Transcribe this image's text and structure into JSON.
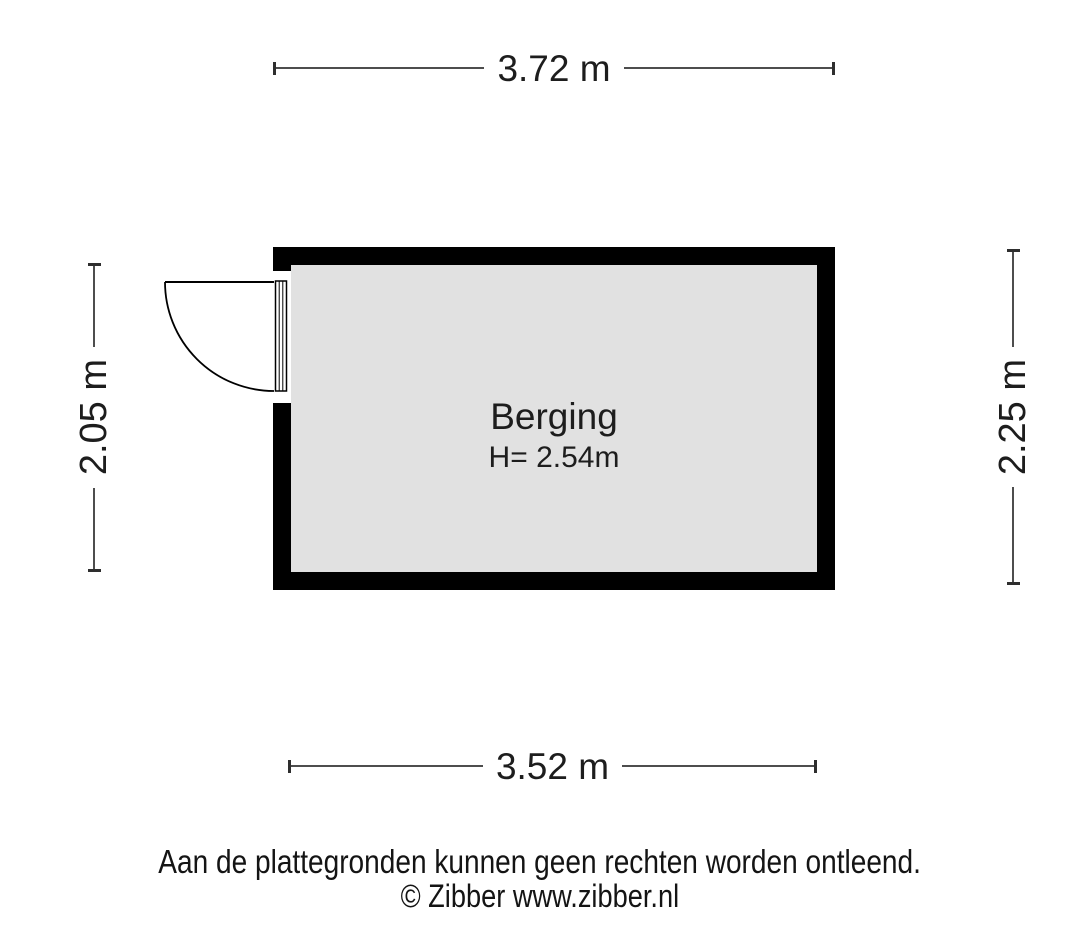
{
  "floorplan": {
    "room": {
      "name": "Berging",
      "height_label": "H= 2.54m"
    },
    "dimensions": {
      "top": "3.72 m",
      "bottom": "3.52 m",
      "left": "2.05 m",
      "right": "2.25 m"
    },
    "footer": {
      "disclaimer": "Aan de plattegronden kunnen geen rechten worden ontleend.",
      "copyright": "© Zibber www.zibber.nl"
    },
    "colors": {
      "wall": "#000000",
      "floor": "#e1e1e1",
      "dimension_line": "#4d4d4d",
      "text": "#1d1d1d",
      "background": "#ffffff"
    }
  }
}
